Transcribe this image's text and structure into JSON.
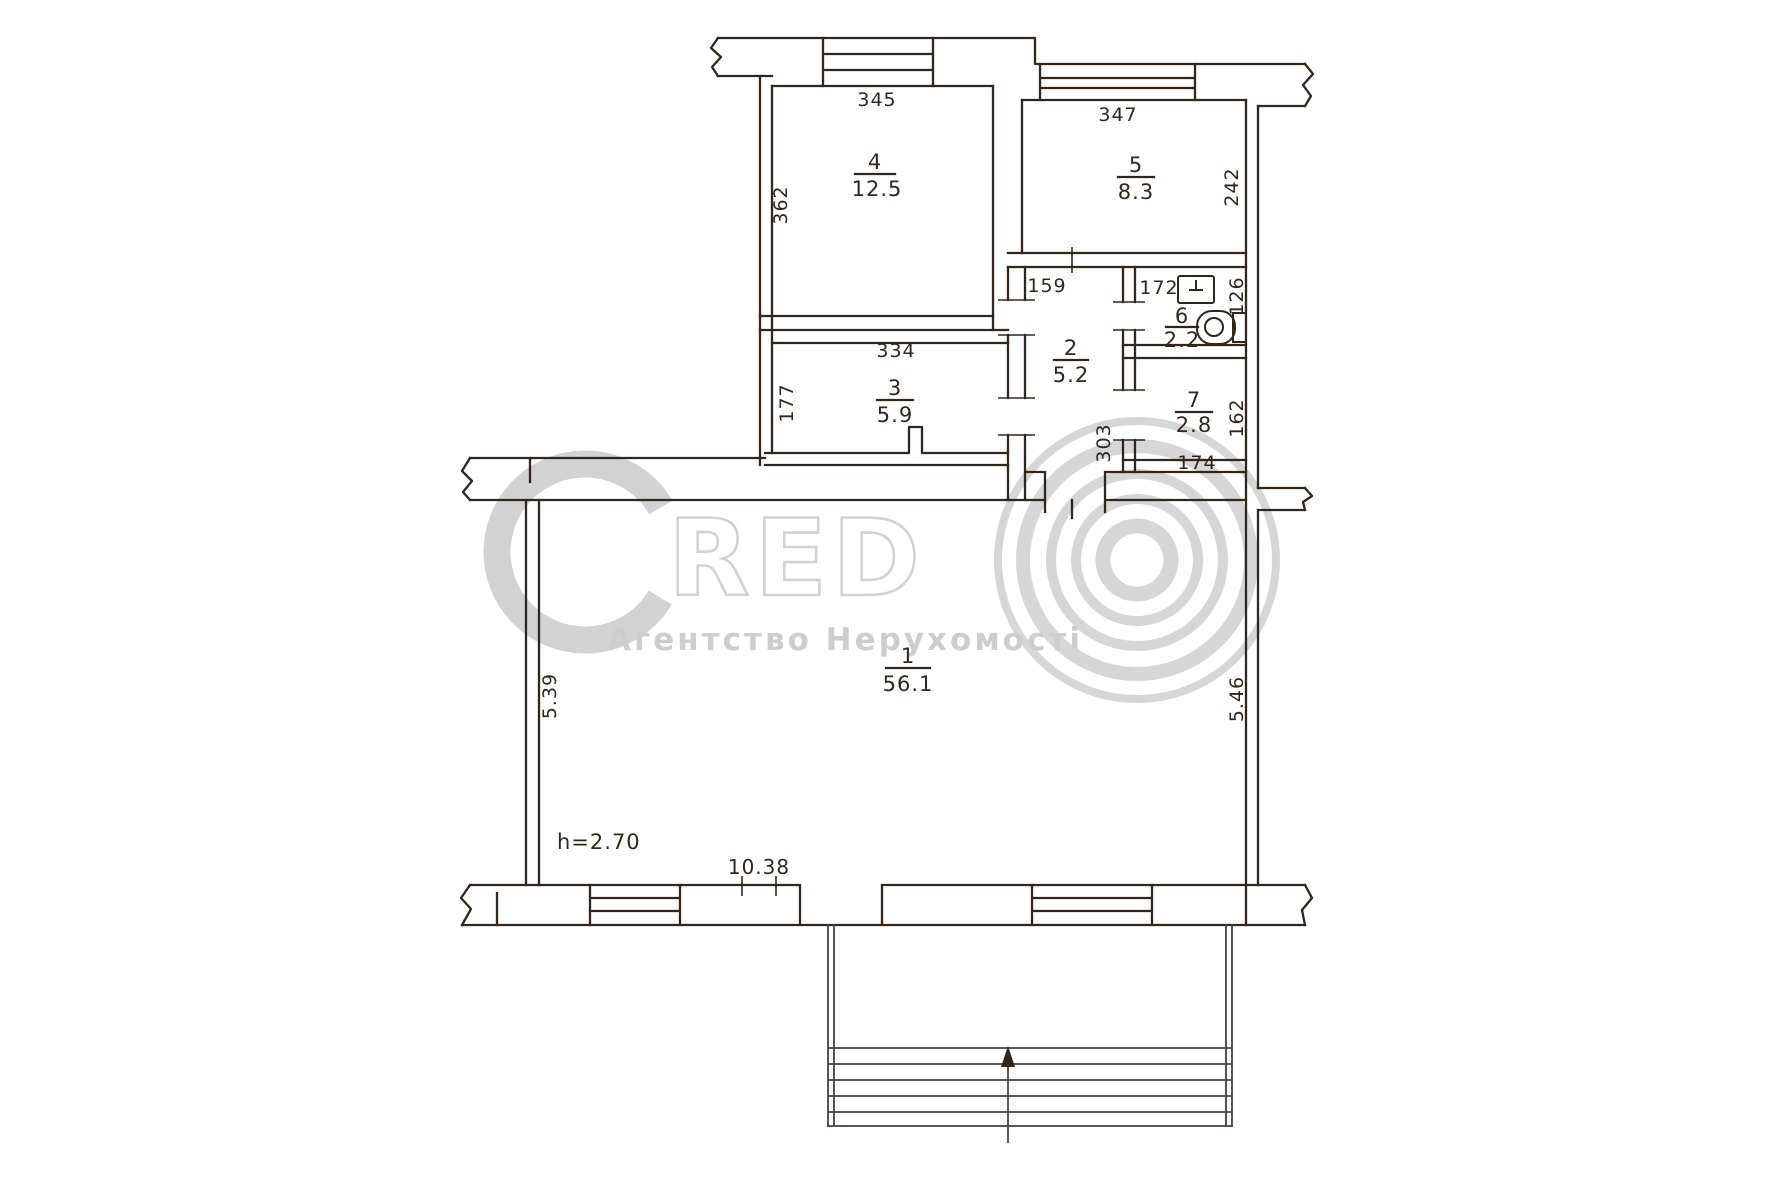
{
  "watermark": {
    "logo_c": "C",
    "logo_red": "RED",
    "subtitle": "Агентство Нерухомості"
  },
  "plan": {
    "height_note": "h=2.70",
    "bottom_length": "10.38",
    "rooms": [
      {
        "number": "1",
        "area": "56.1",
        "dim_left": "5.39",
        "dim_right": "5.46"
      },
      {
        "number": "2",
        "area": "5.2",
        "dim_top": "159",
        "dim_side": "303"
      },
      {
        "number": "3",
        "area": "5.9",
        "dim_top": "334",
        "dim_side": "177"
      },
      {
        "number": "4",
        "area": "12.5",
        "dim_top": "345",
        "dim_side": "362"
      },
      {
        "number": "5",
        "area": "8.3",
        "dim_top": "347",
        "dim_side": "242"
      },
      {
        "number": "6",
        "area": "2.2",
        "dim_top": "172",
        "dim_side": "126"
      },
      {
        "number": "7",
        "area": "2.8",
        "dim_side": "162",
        "dim_bottom": "174"
      }
    ]
  },
  "icons": {
    "sink": "sink-icon",
    "toilet": "toilet-icon",
    "entrance_arrow": "arrow-up-icon",
    "wall_break": "wall-break-mark"
  },
  "colors": {
    "ink": "#32261a",
    "watermark": "#d2d2d2",
    "background": "#ffffff"
  }
}
